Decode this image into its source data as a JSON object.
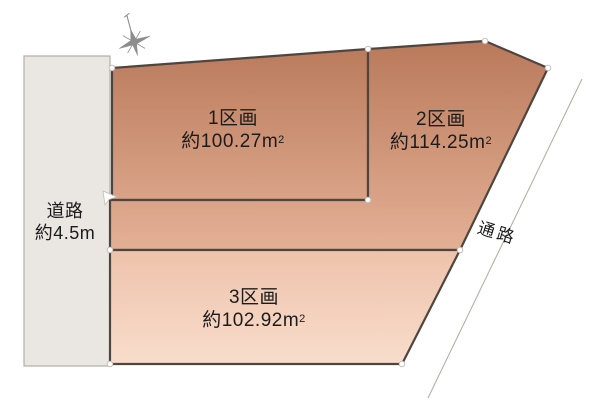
{
  "diagram": {
    "type": "land-plot-subdivision-diagram",
    "road": {
      "name": "道路",
      "width_label": "約4.5m"
    },
    "plots": [
      {
        "id": "plot-1",
        "name": "1区画",
        "area": "約100.27m",
        "area_unit_sup": "2"
      },
      {
        "id": "plot-2",
        "name": "2区画",
        "area": "約114.25m",
        "area_unit_sup": "2"
      },
      {
        "id": "plot-3",
        "name": "3区画",
        "area": "約102.92m",
        "area_unit_sup": "2"
      }
    ],
    "passage": {
      "name": "通路"
    },
    "compass": {
      "name": "compass-rose"
    },
    "colors": {
      "plot_upper_gradient_top": "#b9795b",
      "plot_upper_gradient_bottom": "#e4b095",
      "plot_lower_gradient_top": "#eec2ab",
      "plot_lower_gradient_bottom": "#f8ddcc",
      "plot_outline": "#4f453f",
      "road_fill": "#eae6e2",
      "road_outline": "#b6afa9",
      "passage_line": "#b6afa9",
      "text": "#1c1c1c",
      "background": "#ffffff"
    }
  }
}
